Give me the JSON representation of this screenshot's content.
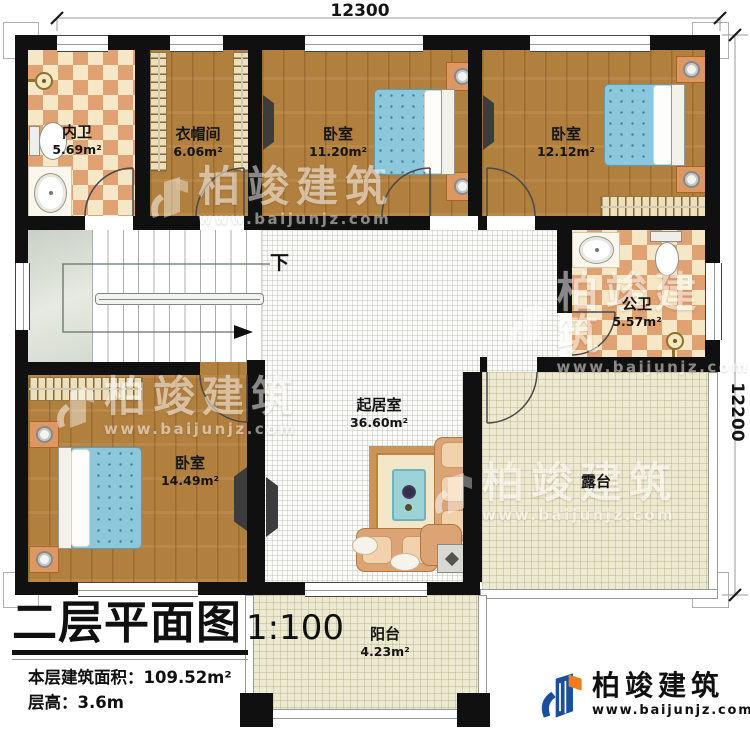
{
  "meta": {
    "title": "二层平面图",
    "scale": "1:100",
    "area_label": "本层建筑面积：",
    "area_value": "109.52m²",
    "height_label": "层高：",
    "height_value": "3.6m"
  },
  "dimensions": {
    "top": "12300",
    "right": "12200"
  },
  "stairs": {
    "direction_label": "下"
  },
  "rooms": [
    {
      "id": "neiwei",
      "name": "内卫",
      "area": "5.69m²"
    },
    {
      "id": "yimaojian",
      "name": "衣帽间",
      "area": "6.06m²"
    },
    {
      "id": "bedroom-top",
      "name": "卧室",
      "area": "11.20m²"
    },
    {
      "id": "bedroom-topright",
      "name": "卧室",
      "area": "12.12m²"
    },
    {
      "id": "gongwei",
      "name": "公卫",
      "area": "5.57m²"
    },
    {
      "id": "living-room",
      "name": "起居室",
      "area": "36.60m²"
    },
    {
      "id": "bedroom-left",
      "name": "卧室",
      "area": "14.49m²"
    },
    {
      "id": "terrace",
      "name": "露台",
      "area": ""
    },
    {
      "id": "balcony",
      "name": "阳台",
      "area": "4.23m²"
    }
  ],
  "branding": {
    "logo_text": "柏竣建筑",
    "logo_url": "www.baijunjz.com",
    "watermark_text": "柏竣建筑",
    "watermark_url": "www.baijunjz.com"
  },
  "colors": {
    "wall": "#101010",
    "wood_floor": "#b17f3e",
    "tile_accent": "#e1a273",
    "stairs": "#dbe1d8",
    "bed_fabric": "#8bc8dc",
    "terrace_floor": "#edead3",
    "logo_blue": "#1a4f9c",
    "logo_orange": "#f07c1c"
  }
}
